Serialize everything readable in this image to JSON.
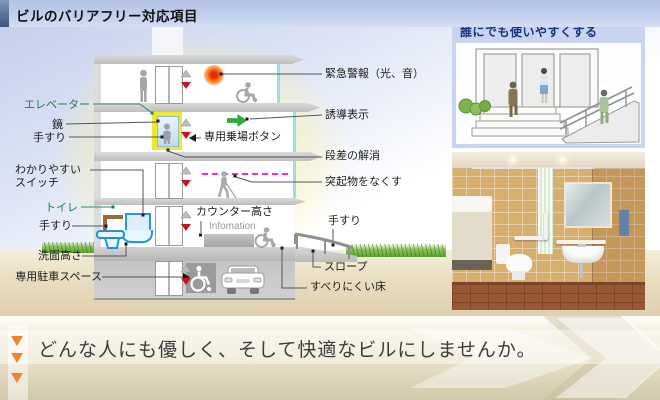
{
  "title": "ビルのバリアフリー対応項目",
  "labels": {
    "elevator": "エレベーター",
    "mirror": "鏡",
    "handrail_elevator": "手すり",
    "switch_line1": "わかりやすい",
    "switch_line2": "スイッチ",
    "toilet": "トイレ",
    "handrail_toilet": "手すり",
    "washbasin_height": "洗面高さ",
    "parking_space": "専用駐車スペース",
    "emergency_alarm": "緊急警報（光、音）",
    "guidance_sign": "誘導表示",
    "platform_button": "専用乗場ボタン",
    "step_elimination": "段差の解消",
    "no_protrusions": "突起物をなくす",
    "counter_height": "カウンター高さ",
    "information": "Infomation",
    "handrail_ramp": "手すり",
    "slope": "スロープ",
    "nonslip_floor": "すべりにくい床"
  },
  "illustration_panel": {
    "title": "誰にでも使いやすくする"
  },
  "banner": {
    "text": "どんな人にも優しく、そして快適なビルにしませんか。"
  },
  "colors": {
    "title_accent": "#3d5582",
    "label_green": "#1e7a50",
    "elevator_highlight_yellow": "#f0e82e",
    "guidance_green": "#2faa3f",
    "alarm_orange": "#ff8830",
    "protrusion_magenta": "#ff2ad4",
    "banner_triangle_orange": "#ef8333",
    "panel_blue": "#c9d4f1"
  }
}
